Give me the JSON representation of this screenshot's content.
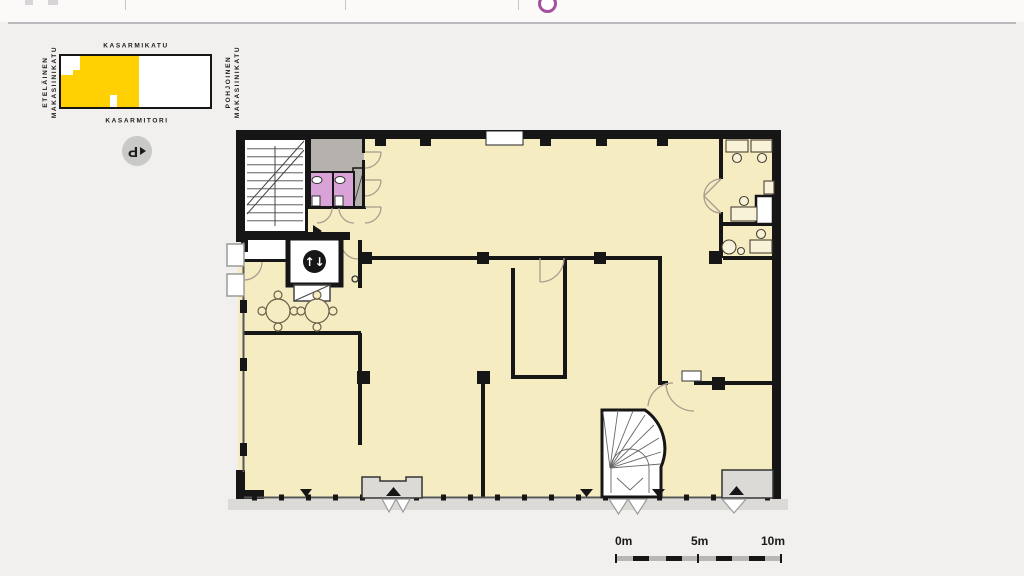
{
  "header": {
    "accent_color": "#A4509E"
  },
  "locator_map": {
    "street_top": "KASARMIKATU",
    "street_bottom": "KASARMITORI",
    "street_left_line1": "ETELÄINEN",
    "street_left_line2": "MAKASIINIKATU",
    "street_right_line1": "POHJOINEN",
    "street_right_line2": "MAKASIINIKATU",
    "block_highlight_color": "#FFD103"
  },
  "parking_badge": {
    "letter": "P"
  },
  "floorplan": {
    "colors": {
      "floor": "#F6ECC2",
      "wall": "#161616",
      "wc_room": "#D9A3D7",
      "service_room": "#B5B2AE",
      "entrance_vestibule": "#DCDAD6",
      "sidewalk": "#DBDAD6",
      "door_arc": "#A89E8F"
    },
    "elevator_glyph": "↑↓"
  },
  "scale_bar": {
    "start": "0m",
    "mid": "5m",
    "end": "10m"
  }
}
